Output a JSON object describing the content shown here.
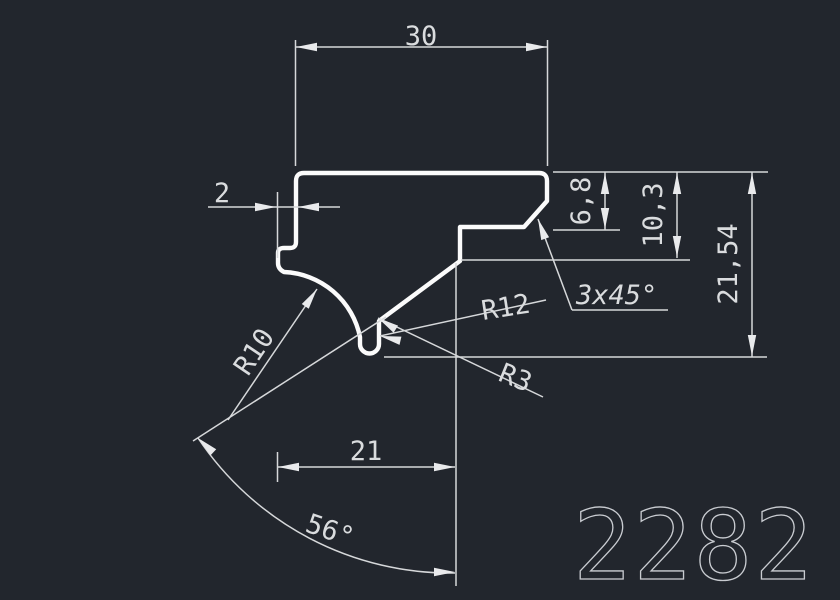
{
  "meta": {
    "app": "cad-profile-drawing",
    "part_number": "2282"
  },
  "colors": {
    "background": "#22262d",
    "dimension_line": "#d6d8da",
    "part_outline": "#fbfbfb",
    "text": "#dadcde",
    "part_number_stroke": "#c9ccd1"
  },
  "dimensions": {
    "top_width": "30",
    "step_width": "2",
    "depth_small": "6,8",
    "depth_mid": "10,3",
    "total_height": "21,54",
    "chamfer_note": "3x45°",
    "bottom_width": "21",
    "angle": "56°",
    "radius_large": "R10",
    "radius_mid": "R12",
    "radius_small": "R3"
  }
}
